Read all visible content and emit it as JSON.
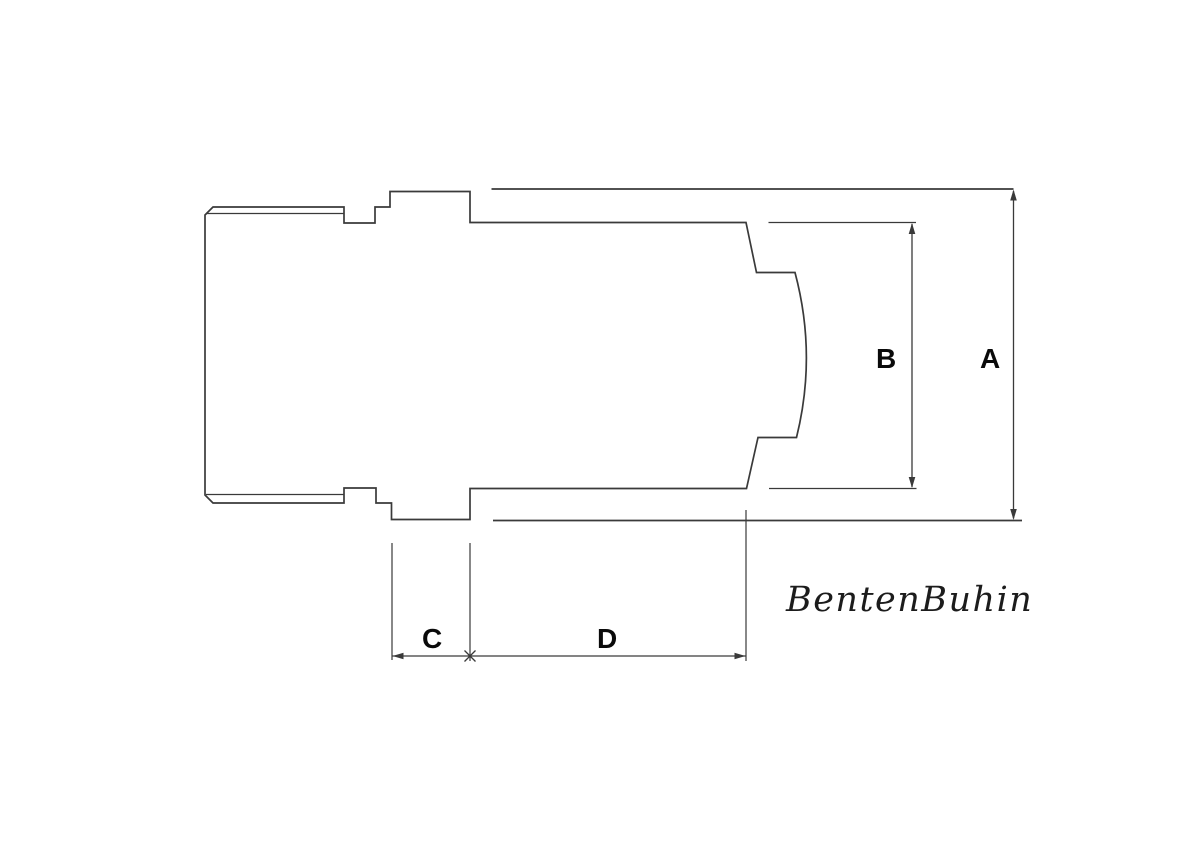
{
  "drawing": {
    "title": "dimension-drawing",
    "labels": {
      "dim_a": "A",
      "dim_b": "B",
      "dim_c": "C",
      "dim_d": "D"
    },
    "watermark": "BentenBuhin",
    "colors": {
      "line": "#3a3a3a",
      "label": "#0a0a0a",
      "watermark": "#1c1c1c",
      "background": "#ffffff"
    }
  }
}
